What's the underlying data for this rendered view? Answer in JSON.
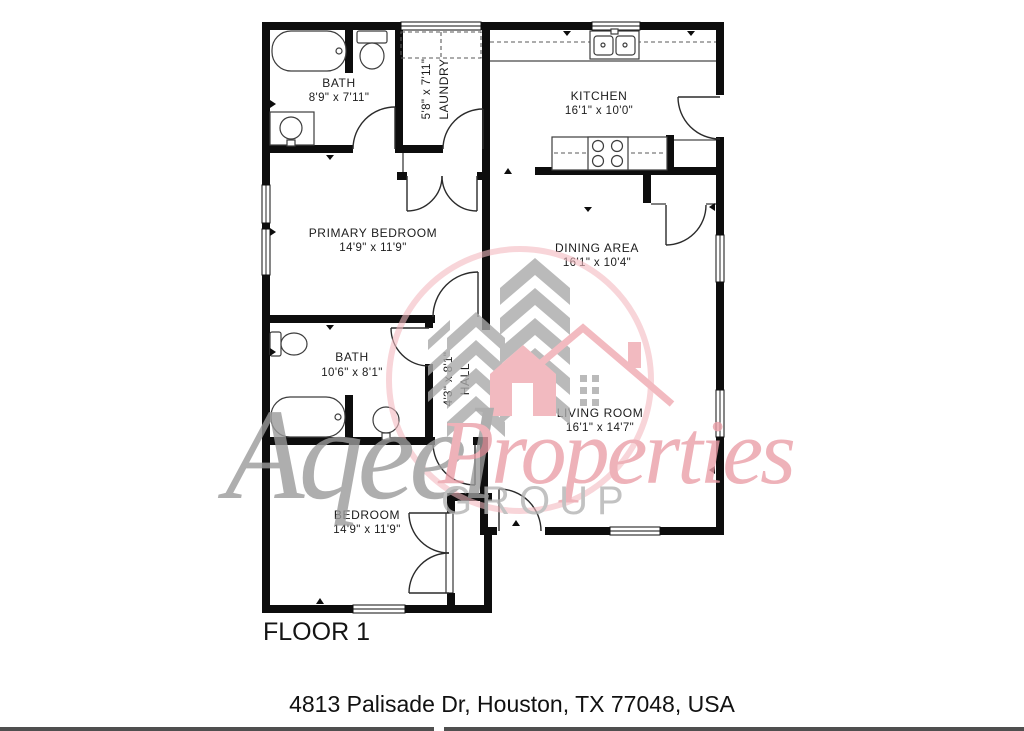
{
  "floor_plan": {
    "floor_label": "FLOOR 1",
    "address": "4813 Palisade Dr, Houston, TX 77048, USA",
    "rooms": [
      {
        "id": "bath-1",
        "name": "BATH",
        "dims": "8'9\" x 7'11\""
      },
      {
        "id": "laundry",
        "name": "LAUNDRY",
        "dims": "5'8\" x 7'11\""
      },
      {
        "id": "kitchen",
        "name": "KITCHEN",
        "dims": "16'1\" x 10'0\""
      },
      {
        "id": "primary-bedroom",
        "name": "PRIMARY BEDROOM",
        "dims": "14'9\" x 11'9\""
      },
      {
        "id": "dining-area",
        "name": "DINING AREA",
        "dims": "16'1\" x 10'4\""
      },
      {
        "id": "bath-2",
        "name": "BATH",
        "dims": "10'6\" x 8'1\""
      },
      {
        "id": "hall",
        "name": "HALL",
        "dims": "4'3\" x 8'1\""
      },
      {
        "id": "living-room",
        "name": "LIVING ROOM",
        "dims": "16'1\" x 14'7\""
      },
      {
        "id": "bedroom",
        "name": "BEDROOM",
        "dims": "14'9\" x 11'9\""
      }
    ]
  },
  "watermark": {
    "brand_script_primary": "Aqeel",
    "brand_script_secondary": "Properties",
    "brand_subtext": "GROUP",
    "pink": "#f0a9b1",
    "gray": "#a9a9a9"
  },
  "colors": {
    "wall": "#0d0d0d",
    "fixture_stroke": "#3d3d3d",
    "bottom_bar": "#4f4f4f",
    "background": "#ffffff"
  }
}
